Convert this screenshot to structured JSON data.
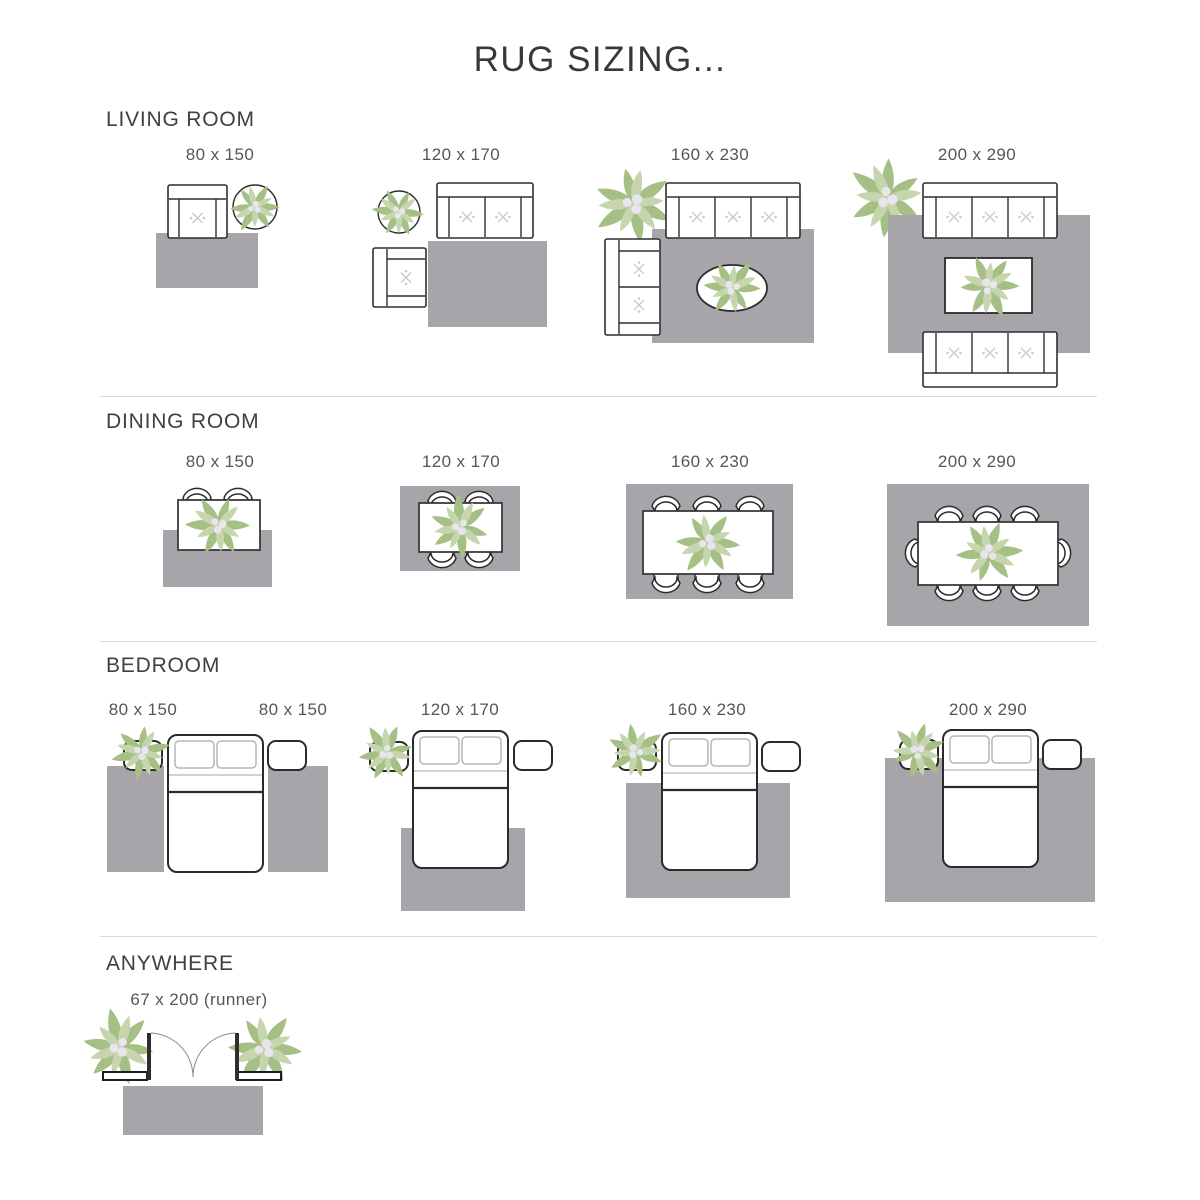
{
  "title": "RUG SIZING...",
  "sections": [
    {
      "label": "LIVING ROOM",
      "items": [
        {
          "label": "80 x 150"
        },
        {
          "label": "120 x 170"
        },
        {
          "label": "160 x 230"
        },
        {
          "label": "200 x 290"
        }
      ]
    },
    {
      "label": "DINING ROOM",
      "items": [
        {
          "label": "80 x 150"
        },
        {
          "label": "120 x 170"
        },
        {
          "label": "160 x 230"
        },
        {
          "label": "200 x 290"
        }
      ]
    },
    {
      "label": "BEDROOM",
      "items": [
        {
          "label": "80 x 150"
        },
        {
          "label": "80 x 150"
        },
        {
          "label": "120 x 170"
        },
        {
          "label": "160 x 230"
        },
        {
          "label": "200 x 290"
        }
      ]
    },
    {
      "label": "ANYWHERE",
      "items": [
        {
          "label": "67 x 200 (runner)"
        }
      ]
    }
  ],
  "colors": {
    "rug": "#a8a5aa",
    "furniture_outline": "#2e2e2e",
    "leaf_green": "#a5bf85",
    "leaf_green_light": "#c6d5ad",
    "flower_accent": "#e9e5ef",
    "heading_text": "#3c4144",
    "label_text": "#53575a",
    "divider": "#dadada"
  }
}
